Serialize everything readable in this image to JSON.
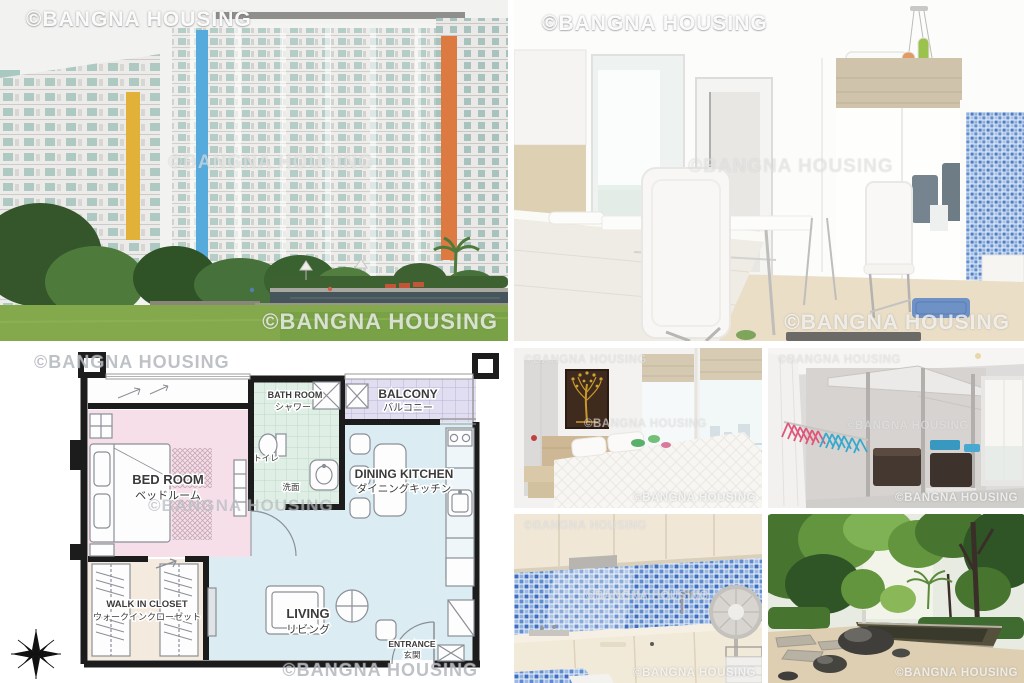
{
  "watermark": {
    "text": "©BANGNA HOUSING",
    "photo_color": "#ffffff",
    "plan_color": "#9aa0a8"
  },
  "floorplan": {
    "wall_color": "#1c1c1c",
    "bedroom": {
      "en": "BED ROOM",
      "ja": "ベッドルーム",
      "fill": "#f6dfe8"
    },
    "bathroom": {
      "en": "BATH ROOM",
      "ja": "シャワー",
      "fill": "#e0efe6"
    },
    "toilet": {
      "ja": "トイレ"
    },
    "washstand": {
      "ja": "洗面"
    },
    "balcony": {
      "en": "BALCONY",
      "ja": "バルコニー",
      "fill": "#e2def1"
    },
    "dining_kitchen": {
      "en": "DINING KITCHEN",
      "ja": "ダイニングキッチン",
      "fill": "#dbedf3"
    },
    "living": {
      "en": "LIVING",
      "ja": "リビング",
      "fill": "#dbedf3"
    },
    "walk_in_closet": {
      "en": "WALK IN CLOSET",
      "ja": "ウォークインクローゼット",
      "fill": "#f4ebde"
    },
    "entrance": {
      "en": "ENTRANCE",
      "ja": "玄関"
    }
  }
}
